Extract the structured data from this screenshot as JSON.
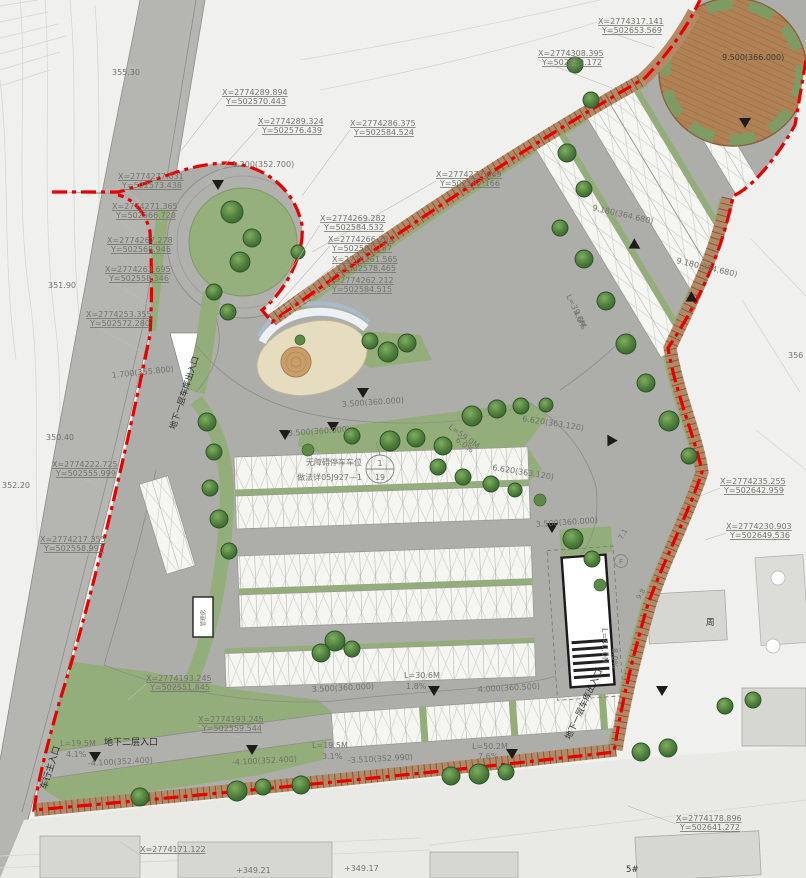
{
  "colors": {
    "boundary_red": "#e80000",
    "pavement_gray": "#adadaa",
    "road_gray": "#b5b5b2",
    "landscape_green": "#93ae7a",
    "edge_band_brown": "#b48a66",
    "deck_brown": "#b08154",
    "stall_white": "#f5f5f2",
    "tree_green": "#3c6b31"
  },
  "coordinate_labels": [
    {
      "x": "X=2774289.894",
      "y": "Y=502570.443"
    },
    {
      "x": "X=2774289.324",
      "y": "Y=502576.439"
    },
    {
      "x": "X=2774286.375",
      "y": "Y=502584.524"
    },
    {
      "x": "X=2774277.849",
      "y": "Y=502587.166"
    },
    {
      "x": "X=2774269.282",
      "y": "Y=502584.532"
    },
    {
      "x": "X=2774266.262",
      "y": "Y=502581.187"
    },
    {
      "x": "X=2774261.565",
      "y": "Y=502578.465"
    },
    {
      "x": "X=2774262.212",
      "y": "Y=502584.515"
    },
    {
      "x": "X=2774277.631",
      "y": "Y=502573.438"
    },
    {
      "x": "X=2774271.365",
      "y": "Y=502566.728"
    },
    {
      "x": "X=2774267.278",
      "y": "Y=502568.946"
    },
    {
      "x": "X=2774263.695",
      "y": "Y=502558.346"
    },
    {
      "x": "X=2774253.355",
      "y": "Y=502572.280"
    },
    {
      "x": "X=2774317.141",
      "y": "Y=502653.569"
    },
    {
      "x": "X=2774308.395",
      "y": "Y=502649.172"
    },
    {
      "x": "X=2774222.725",
      "y": "Y=502555.999"
    },
    {
      "x": "X=2774217.355",
      "y": "Y=502558.997"
    },
    {
      "x": "X=2774235.255",
      "y": "Y=502642.959"
    },
    {
      "x": "X=2774230.903",
      "y": "Y=502649.536"
    },
    {
      "x": "X=2774178.896",
      "y": "Y=502641.272"
    },
    {
      "x": "X=2774193.245",
      "y": "Y=502551.845"
    },
    {
      "x": "X=2774193.245",
      "y": "Y=502559.544"
    },
    {
      "x": "X=2774171.122",
      "y": ""
    }
  ],
  "elevation_labels": [
    "1.200(352.700)",
    "1.700(355.800)",
    "9.500(366.000)",
    "9.180(364.680)",
    "9.180(364.680)",
    "3.500(360.000)",
    "3.500(360.000)",
    "6.620(363.120)",
    "6.620(363.120)",
    "3.500(360.000)",
    "3.500(360.000)",
    "4.000(360.500)",
    "-3.510(352.990)",
    "-4.100(352.400)",
    "-4.100(352.400)"
  ],
  "slope_labels": [
    {
      "length": "L=19.5M",
      "grade": "4.1%"
    },
    {
      "length": "L=19.5M",
      "grade": "3.1%"
    },
    {
      "length": "L=50.2M",
      "grade": "7.6%"
    },
    {
      "length": "L=30.6M",
      "grade": "1.8%"
    },
    {
      "length": "L=59.0M",
      "grade": "6.0%"
    },
    {
      "length": "L=39.6M",
      "grade": "4.0%"
    },
    {
      "length": "L=40.0M",
      "grade": "8.0%"
    }
  ],
  "entrance_labels": {
    "vehicle_main_entrance": "车行主入口",
    "basement_level2_entrance": "地下二层入口",
    "basement_level1_garage_entrance": "地下一层车库出入口"
  },
  "detail_callout": {
    "caption_line1": "无障碍停车车位",
    "caption_line2": "做法详05J927—1",
    "circle_top": "1",
    "circle_bottom": "19"
  },
  "spot_elevations": [
    "355.30",
    "351.90",
    "350.40",
    "352.20",
    "+349.17",
    "+349.21",
    "356"
  ],
  "misc_labels": {
    "building_right": "周",
    "building_bottom": "5#",
    "ramp_circle_letter": "F",
    "guard_room": "管理房",
    "dim_a": "7.1",
    "dim_b": "9.8"
  }
}
